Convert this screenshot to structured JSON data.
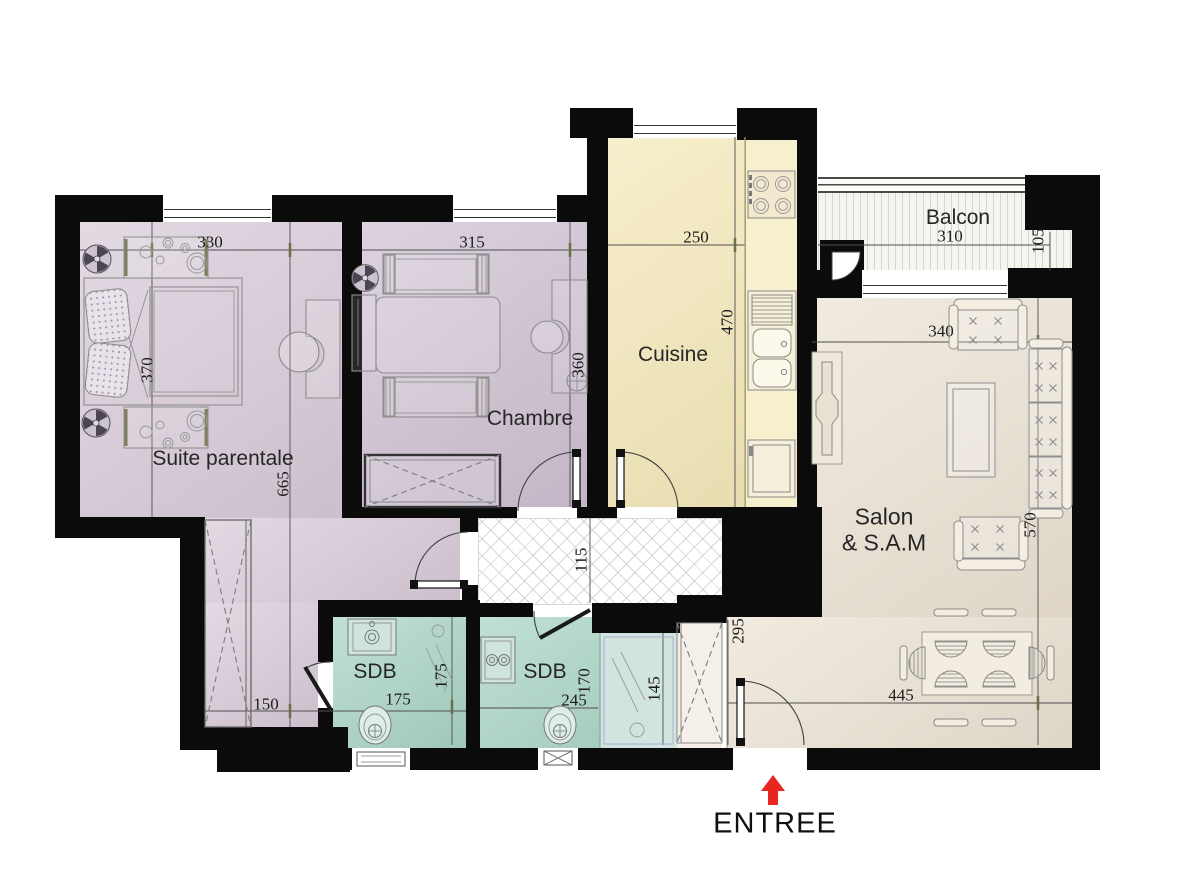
{
  "plan": {
    "entry": {
      "label": "ENTREE"
    },
    "rooms": {
      "suite": {
        "label": "Suite parentale",
        "dim_width_top": "330",
        "dim_bed_depth": "370",
        "dim_length": "665",
        "dim_bottom": "150"
      },
      "chambre": {
        "label": "Chambre",
        "dim_width_top": "315",
        "dim_depth": "360"
      },
      "cuisine": {
        "label": "Cuisine",
        "dim_width_top": "250",
        "dim_depth": "470"
      },
      "balcon": {
        "label": "Balcon",
        "dim_width": "310",
        "dim_depth": "105"
      },
      "salon": {
        "label_line1": "Salon",
        "label_line2": "& S.A.M",
        "dim_width_top": "340",
        "dim_depth": "570",
        "dim_width_bottom": "445",
        "dim_entry_side": "295"
      },
      "hall": {
        "dim_width": "115"
      },
      "sdb1": {
        "label": "SDB",
        "dim_width": "175",
        "dim_depth": "175"
      },
      "sdb2": {
        "label": "SDB",
        "dim_width": "245",
        "dim_depth": "170",
        "dim_shower": "145"
      }
    },
    "colors": {
      "wall": "#0b0b0b",
      "suite": "#d8cbd9",
      "chambre": "#cfc1d2",
      "cuisine": "#f5e9b9",
      "cuisine_counter": "#f7f0cf",
      "salon": "#ece3d4",
      "sdb": "#a9d4c5",
      "sdb_light": "#d2e4df",
      "balcon": "#f6f4ee",
      "closet": "#f4f0e9",
      "arrow": "#e8261f",
      "dim": "#1c1c1c"
    }
  }
}
